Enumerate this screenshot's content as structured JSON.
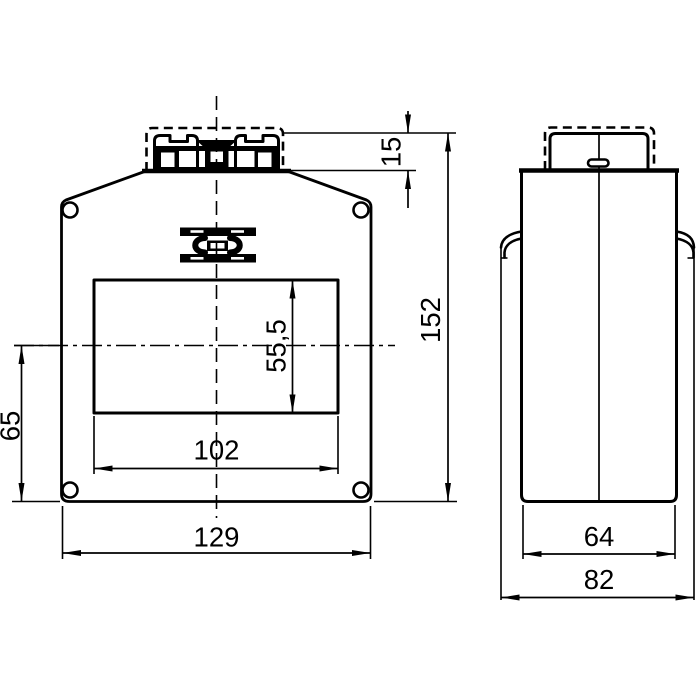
{
  "background": "#ffffff",
  "line_color": "#000000",
  "views": {
    "front": {
      "label": "front-view",
      "dimensions": {
        "terminal_height": "15",
        "overall_height": "152",
        "window_height": "55,5",
        "window_center_to_bottom": "65",
        "window_width": "102",
        "overall_width": "129"
      }
    },
    "side": {
      "label": "side-view",
      "dimensions": {
        "body_width": "64",
        "overall_width": "82"
      }
    }
  }
}
